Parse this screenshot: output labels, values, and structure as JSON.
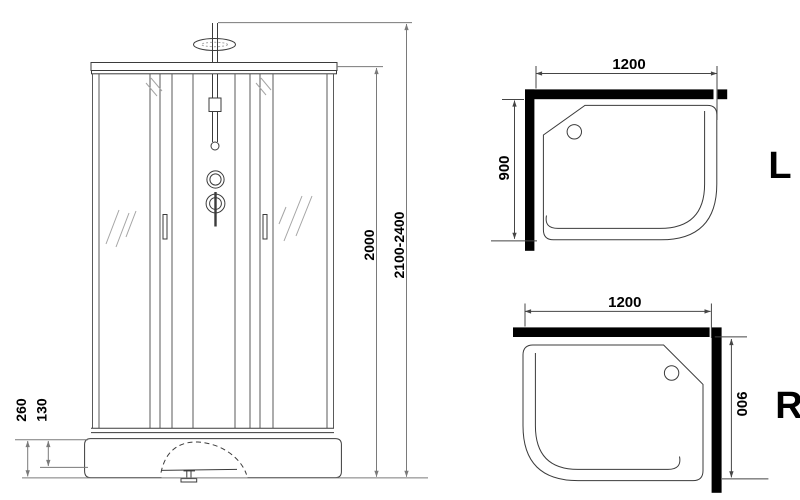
{
  "front_view": {
    "glass_height": "2000",
    "total_height": "2100-2400",
    "base_height": "260",
    "base_mid_height": "130"
  },
  "top_view_left": {
    "width": "1200",
    "depth": "900",
    "label": "L"
  },
  "top_view_right": {
    "width": "1200",
    "depth": "900",
    "label": "R"
  }
}
